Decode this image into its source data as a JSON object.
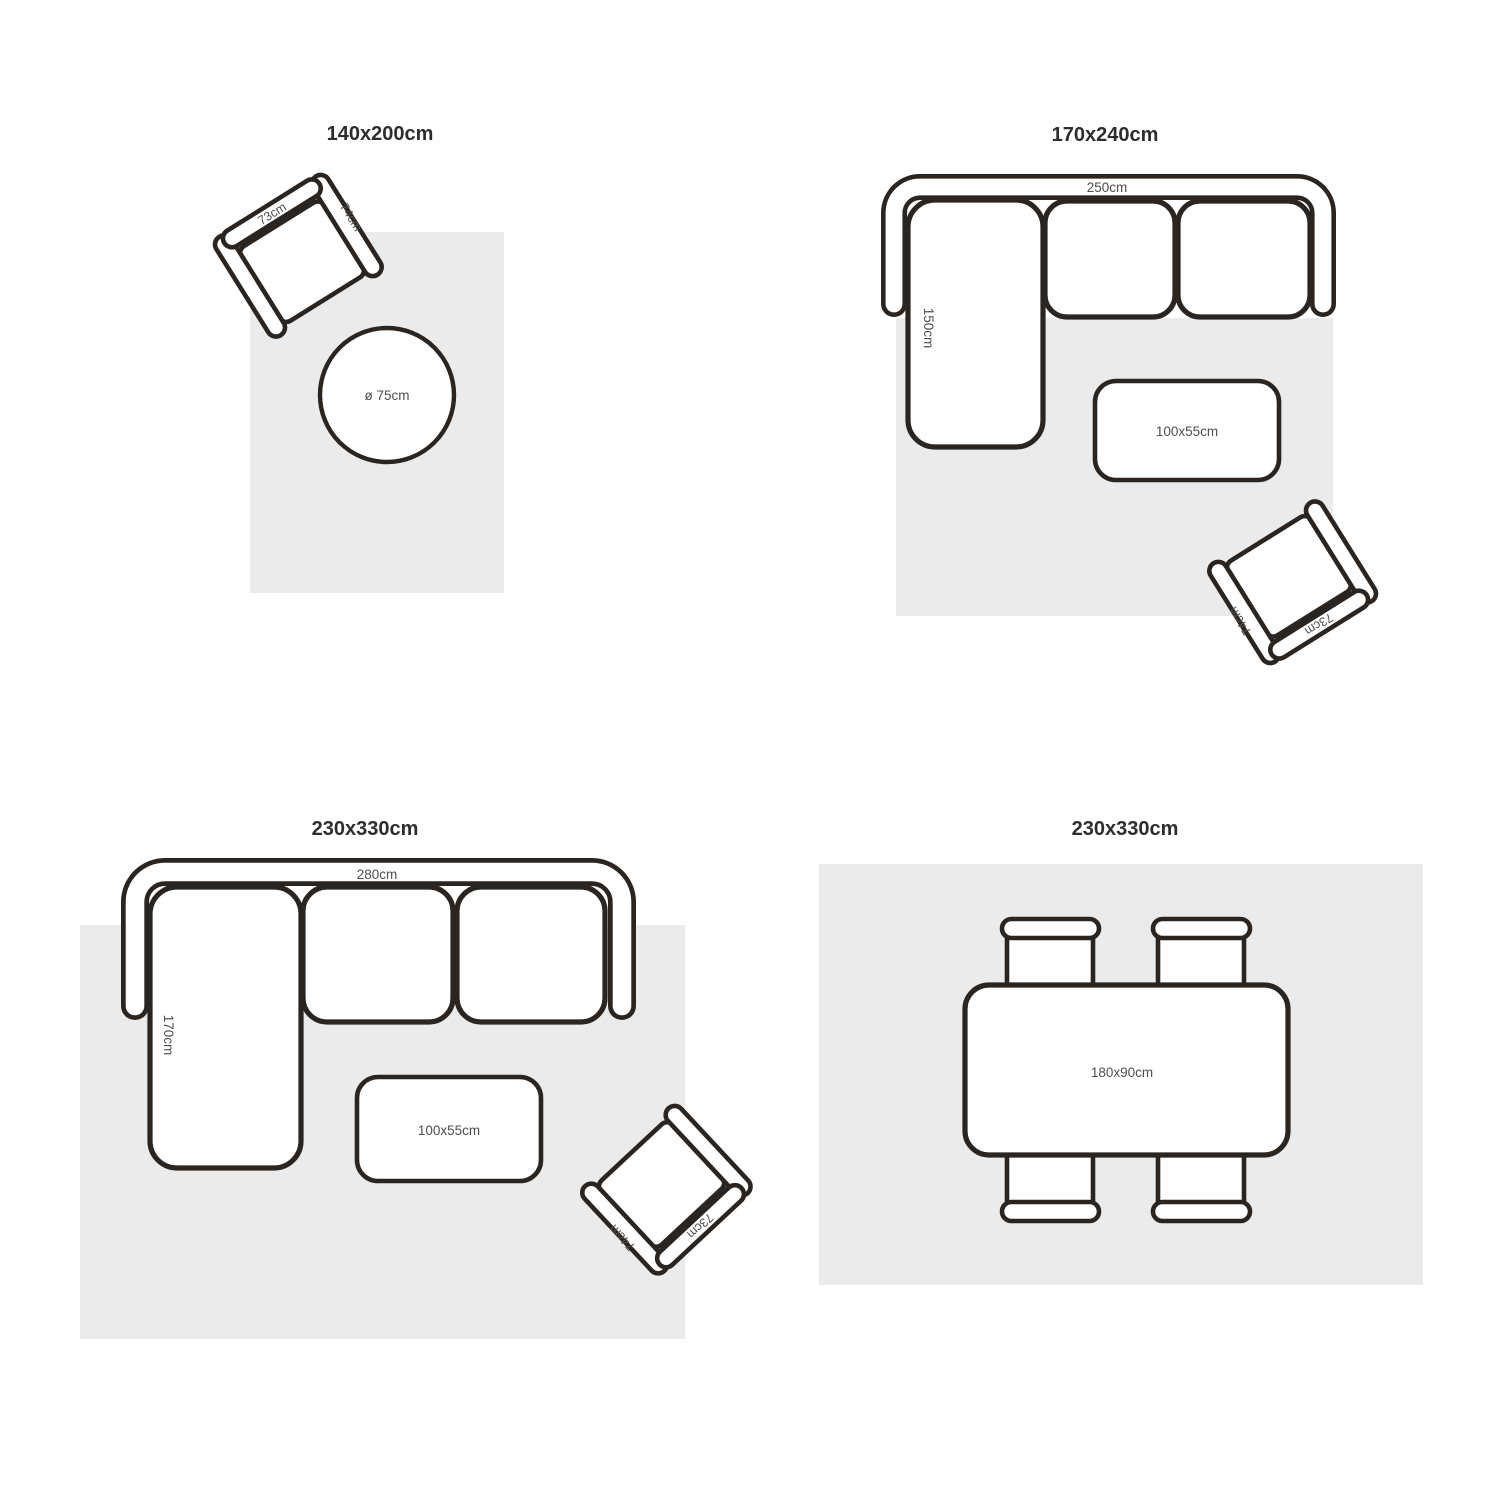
{
  "colors": {
    "background": "#ffffff",
    "rug": "#ebebeb",
    "outline": "#2a2521",
    "furniture_fill": "#ffffff",
    "label_text": "#4f4f4f",
    "title_text": "#2d2d2d"
  },
  "panels": {
    "p1": {
      "title": "140x200cm",
      "chair_back": "73cm",
      "chair_arm": "74cm",
      "round_table": "ø 75cm"
    },
    "p2": {
      "title": "170x240cm",
      "sofa_width": "250cm",
      "chaise_depth": "150cm",
      "coffee_table": "100x55cm",
      "chair_back": "73cm",
      "chair_arm": "74cm"
    },
    "p3": {
      "title": "230x330cm",
      "sofa_width": "280cm",
      "chaise_depth": "170cm",
      "coffee_table": "100x55cm",
      "chair_back": "73cm",
      "chair_arm": "74cm"
    },
    "p4": {
      "title": "230x330cm",
      "dining_table": "180x90cm"
    }
  }
}
